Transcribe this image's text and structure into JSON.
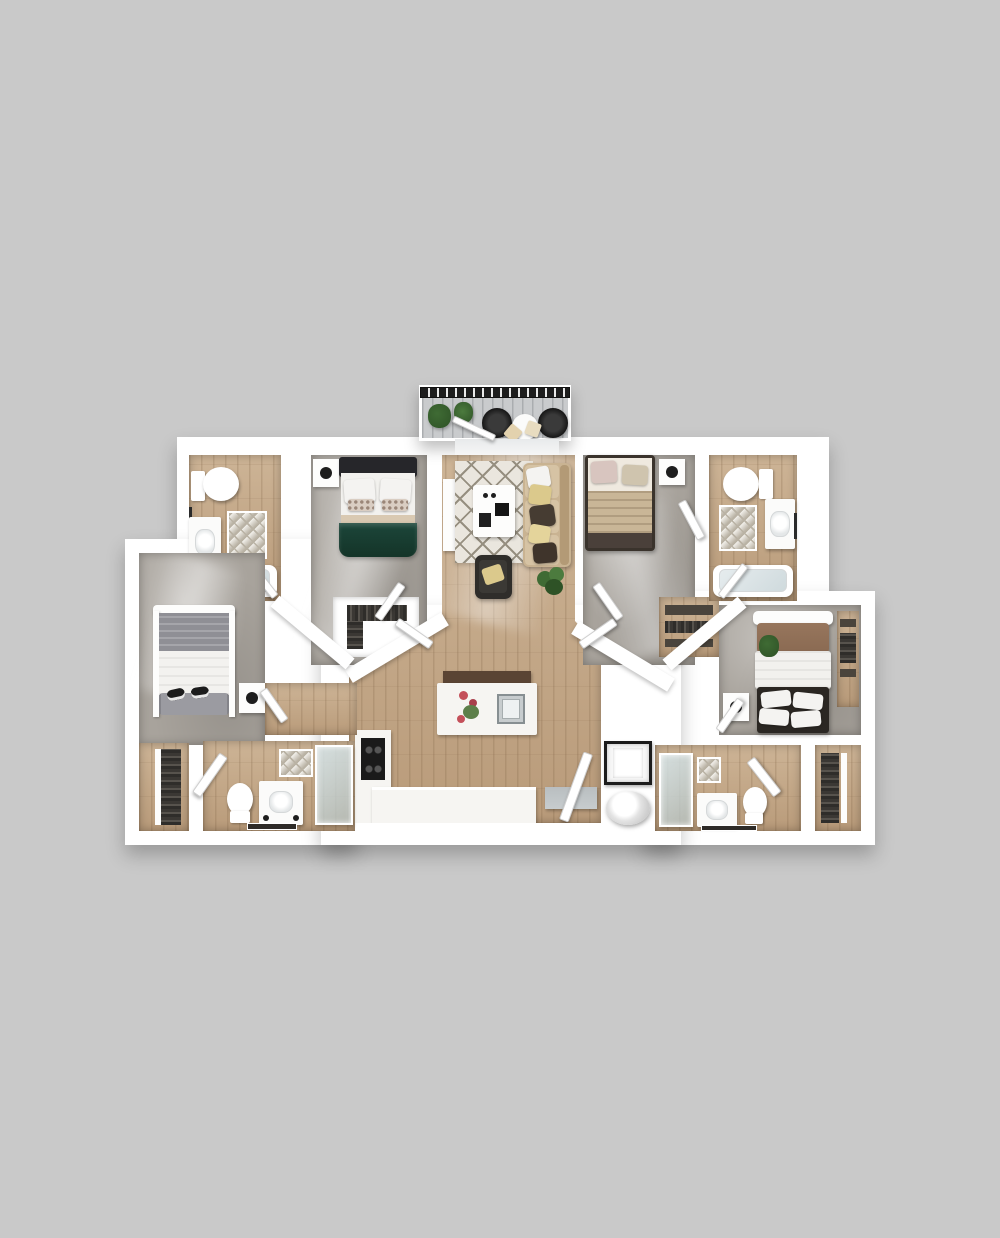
{
  "meta": {
    "title": "3D top-down floor plan rendering of a four-bedroom apartment",
    "canvas": {
      "width": 1000,
      "height": 1238
    },
    "visible_text": "none"
  },
  "palette": {
    "background": "#c9c9c9",
    "wall": "#ffffff",
    "wall_shadow": "#d2d0cd",
    "concrete": "#a8a39c",
    "concrete_light": "#c6c2bb",
    "wood": "#cdb496",
    "wood_dark": "#b99b7a",
    "plank_line": "#8a7253",
    "deck": "#c9cbcd",
    "railing": "#1d1d1d",
    "green_bed": "#1c463a",
    "headboard_dark": "#26262a",
    "tan_bed": "#c9b697",
    "bed_frame_brown": "#3a332c",
    "brown_blanket": "#8a6a52",
    "gray_blanket": "#8f8f95",
    "sofa": "#c9b392",
    "sofa_light": "#d6c3a4",
    "armchair": "#2f2d2a",
    "rug_base": "#eae6de",
    "rug_line": "#968f80",
    "plant": "#3f6b34",
    "plant_dark": "#2e5226",
    "pillow_white": "#f4f3f1",
    "pillow_yellow": "#dbc98c",
    "pillow_dark": "#463c32",
    "pillow_pink": "#d8c5bf",
    "counter": "#f6f5f2",
    "cabinet": "#d8cbb4",
    "cooktop": "#1a1a1a",
    "steel": "#c7ccce",
    "glass": "#ccd8da",
    "mat_line": "#b9b2a4",
    "clothes_dark": "#35332f",
    "flower_red": "#c4505a"
  },
  "scene": {
    "type": "floor-plan-3d-top-view",
    "rooms": [
      {
        "name": "balcony",
        "floor": "gray plank deck",
        "furniture": [
          "black railing",
          "two potted plants",
          "two black round chairs with tan cushions",
          "small white table"
        ]
      },
      {
        "name": "bathroom-top-left",
        "floor": "wood",
        "furniture": [
          "toilet",
          "vanity sink",
          "diamond bath mat",
          "bathtub",
          "towel bar",
          "door"
        ]
      },
      {
        "name": "bedroom-top-left",
        "floor": "concrete",
        "furniture": [
          "bed with dark headboard, white pillows and dark green duvet",
          "white nightstand",
          "walk-in closet with hanging clothes"
        ]
      },
      {
        "name": "living-room",
        "floor": "wood",
        "furniture": [
          "white tv console",
          "patterned rug",
          "white coffee table",
          "tan sofa with cream, yellow and dark pillows",
          "dark armchair with yellow pillow",
          "potted plant"
        ]
      },
      {
        "name": "bedroom-top-right",
        "floor": "concrete",
        "furniture": [
          "dark brown bed with pink and beige pillows and striped tan blanket",
          "white nightstand",
          "closet with shelves"
        ]
      },
      {
        "name": "bathroom-top-right",
        "floor": "wood",
        "furniture": [
          "toilet",
          "vanity sink",
          "diamond bath mat",
          "bathtub",
          "door"
        ]
      },
      {
        "name": "bedroom-left-wing",
        "floor": "concrete",
        "furniture": [
          "white-frame bed with gray blanket, white duvet, gray pillows and slippers",
          "white nightstand",
          "door"
        ]
      },
      {
        "name": "closet-bottom-left",
        "floor": "wood",
        "furniture": [
          "shelving with clothes"
        ]
      },
      {
        "name": "bathroom-bottom-left",
        "floor": "wood",
        "furniture": [
          "door",
          "toilet",
          "white vanity",
          "glass shower with tiled wall",
          "dark bath mat"
        ]
      },
      {
        "name": "kitchen",
        "floor": "wood",
        "furniture": [
          "white island with steel sink and flowers",
          "dark bench",
          "L-shaped counter with black cooktop",
          "steel counter",
          "entry door"
        ]
      },
      {
        "name": "utility-closet",
        "floor": "none",
        "furniture": [
          "boxed appliance",
          "round water heater"
        ]
      },
      {
        "name": "bedroom-right-wing",
        "floor": "concrete",
        "furniture": [
          "white-frame bed with brown blanket, white duvet and four white pillows",
          "white nightstand",
          "floor plant",
          "wood closet strip",
          "door"
        ]
      },
      {
        "name": "bathroom-bottom-right",
        "floor": "wood",
        "furniture": [
          "glass shower",
          "tiled wall",
          "white vanity",
          "toilet",
          "dark bath mat",
          "door"
        ]
      },
      {
        "name": "closet-bottom-right",
        "floor": "wood",
        "furniture": [
          "shelving with clothes"
        ]
      }
    ]
  }
}
